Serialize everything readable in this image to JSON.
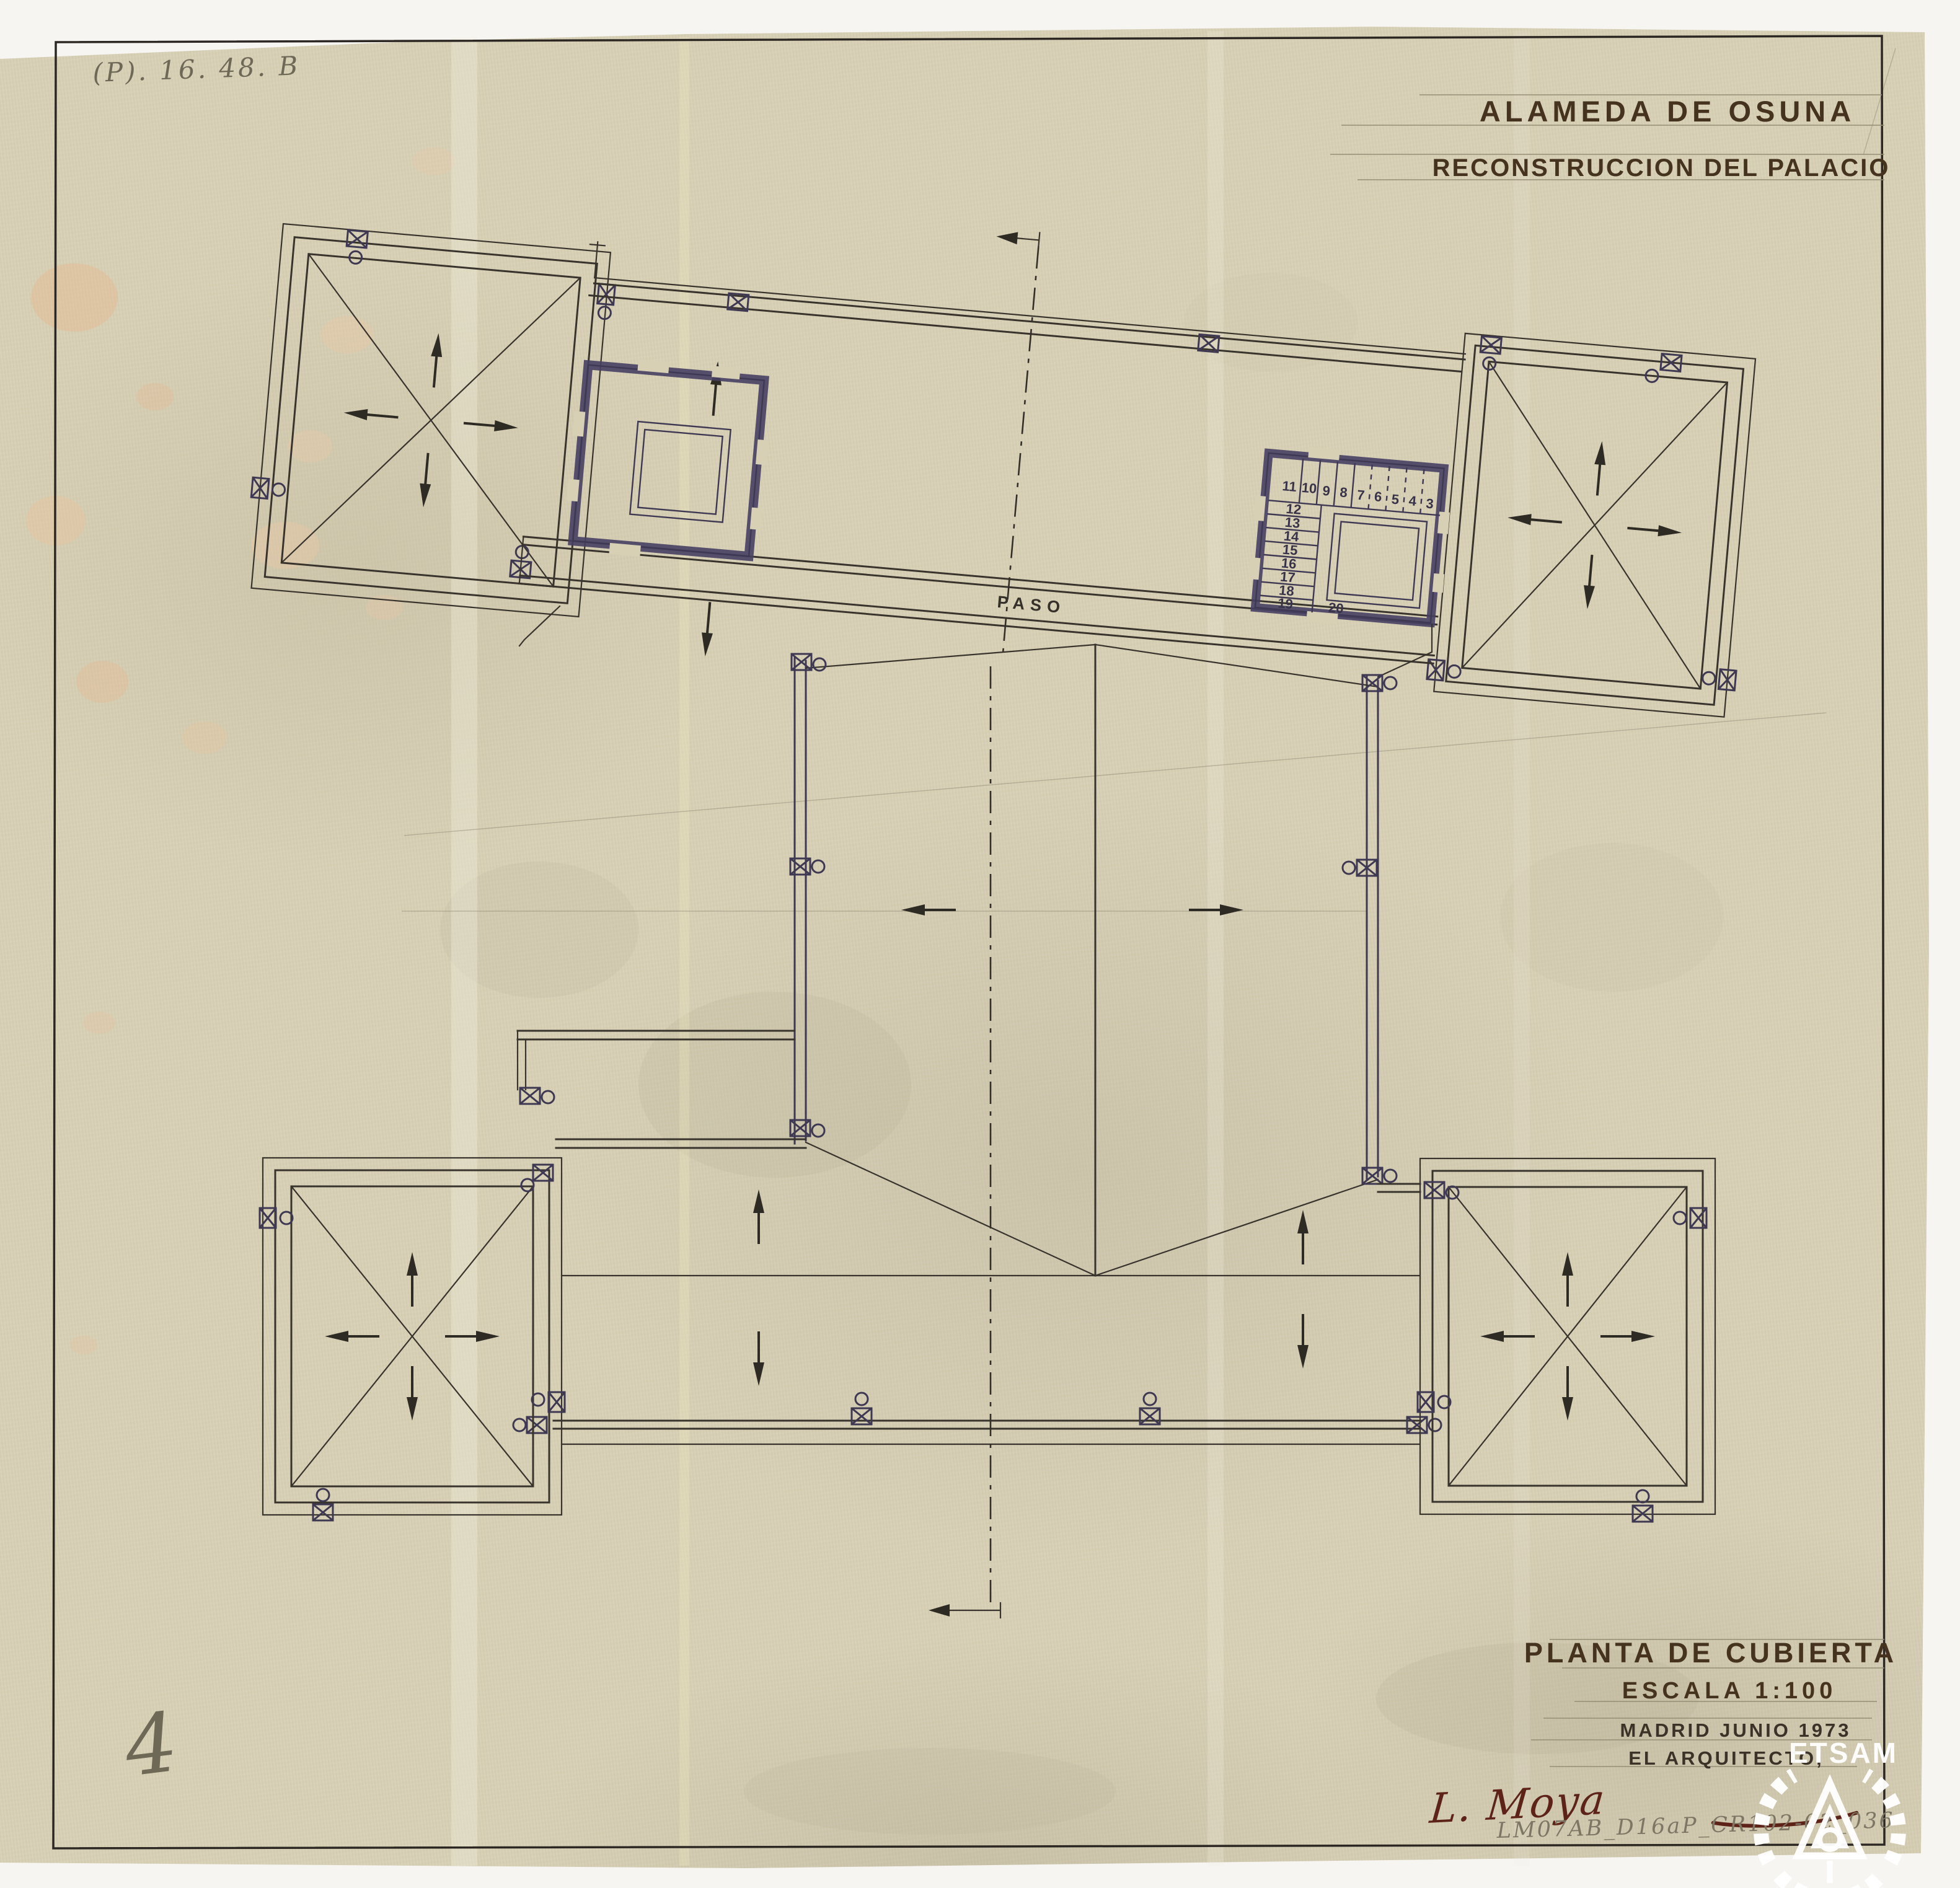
{
  "document": {
    "archive_ref": "(P). 16. 48. B",
    "sheet_number": "4",
    "file_code": "LM07AB_D16aP_CR102-02_036",
    "watermark": "ETSAM"
  },
  "header": {
    "project": "ALAMEDA DE OSUNA",
    "subtitle": "RECONSTRUCCION DEL PALACIO"
  },
  "title_block": {
    "drawing_title": "PLANTA DE CUBIERTA",
    "scale": "ESCALA 1:100",
    "place_date": "MADRID JUNIO 1973",
    "role": "EL ARQUITECTO,",
    "signature": "L. Moya"
  },
  "plan": {
    "corridor_label": "PASO",
    "stair_treads_top": [
      "11",
      "10",
      "9",
      "8",
      "7",
      "6",
      "5",
      "4",
      "3"
    ],
    "stair_treads_side": [
      "12",
      "13",
      "14",
      "15",
      "16",
      "17",
      "18",
      "19",
      "20"
    ]
  },
  "symbols": {
    "chimney": "boxed-x-chimney-with-vent-circle",
    "slope_arrow": "roof-slope-direction-arrow",
    "axis": "dash-dot-section-axis"
  },
  "colors": {
    "paper": "#d7d0b5",
    "scan_background": "#f6f5f2",
    "ink": "#38332c",
    "ink_violet": "#3e3853",
    "pencil": "#968e75",
    "title_ink": "#45331f",
    "signature_ink": "#5e2318"
  }
}
